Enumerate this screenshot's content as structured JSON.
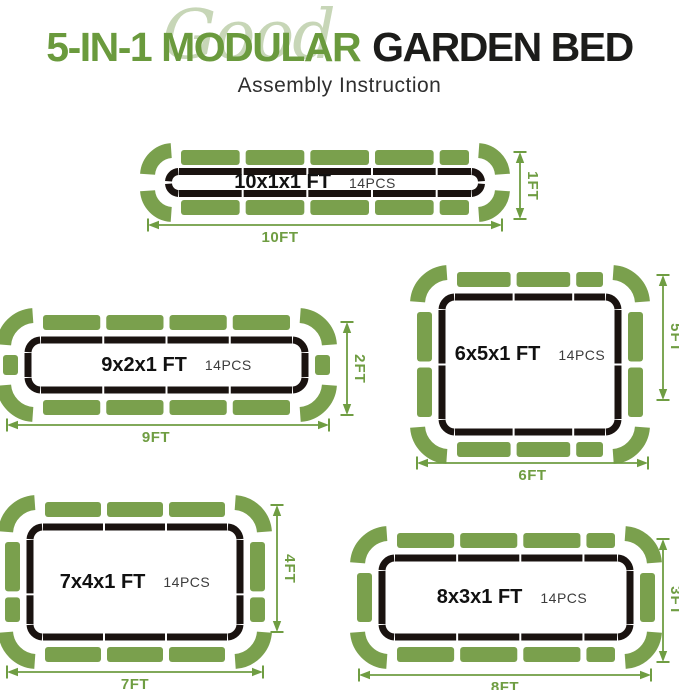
{
  "header": {
    "script_word": "Good",
    "title_green": "5-IN-1 MODULAR",
    "title_dark": "GARDEN BED",
    "subtitle": "Assembly Instruction"
  },
  "colors": {
    "panel_green": "#7aa04d",
    "outline_black": "#1a1310",
    "dimension_green": "#6f9d42",
    "title_green": "#6a9a3d",
    "title_dark": "#1c1c1a",
    "script_green": "#c7d6b7",
    "subtitle_gray": "#2f2f2f",
    "pcs_gray": "#3c3c3c"
  },
  "beds": [
    {
      "size_label": "10x1x1 FT",
      "pcs_label": "14PCS",
      "width_label": "10FT",
      "height_label": "1FT",
      "top_panels": [
        2,
        2,
        2,
        2,
        1
      ],
      "side_panels": []
    },
    {
      "size_label": "9x2x1 FT",
      "pcs_label": "14PCS",
      "width_label": "9FT",
      "height_label": "2FT",
      "top_panels": [
        2,
        2,
        2,
        2
      ],
      "side_panels": [
        1
      ]
    },
    {
      "size_label": "6x5x1 FT",
      "pcs_label": "14PCS",
      "width_label": "6FT",
      "height_label": "5FT",
      "top_panels": [
        2,
        2,
        1
      ],
      "side_panels": [
        2,
        2
      ]
    },
    {
      "size_label": "7x4x1 FT",
      "pcs_label": "14PCS",
      "width_label": "7FT",
      "height_label": "4FT",
      "top_panels": [
        2,
        2,
        2
      ],
      "side_panels": [
        2,
        1
      ]
    },
    {
      "size_label": "8x3x1 FT",
      "pcs_label": "14PCS",
      "width_label": "8FT",
      "height_label": "3FT",
      "top_panels": [
        2,
        2,
        2,
        1
      ],
      "side_panels": [
        2
      ]
    }
  ]
}
